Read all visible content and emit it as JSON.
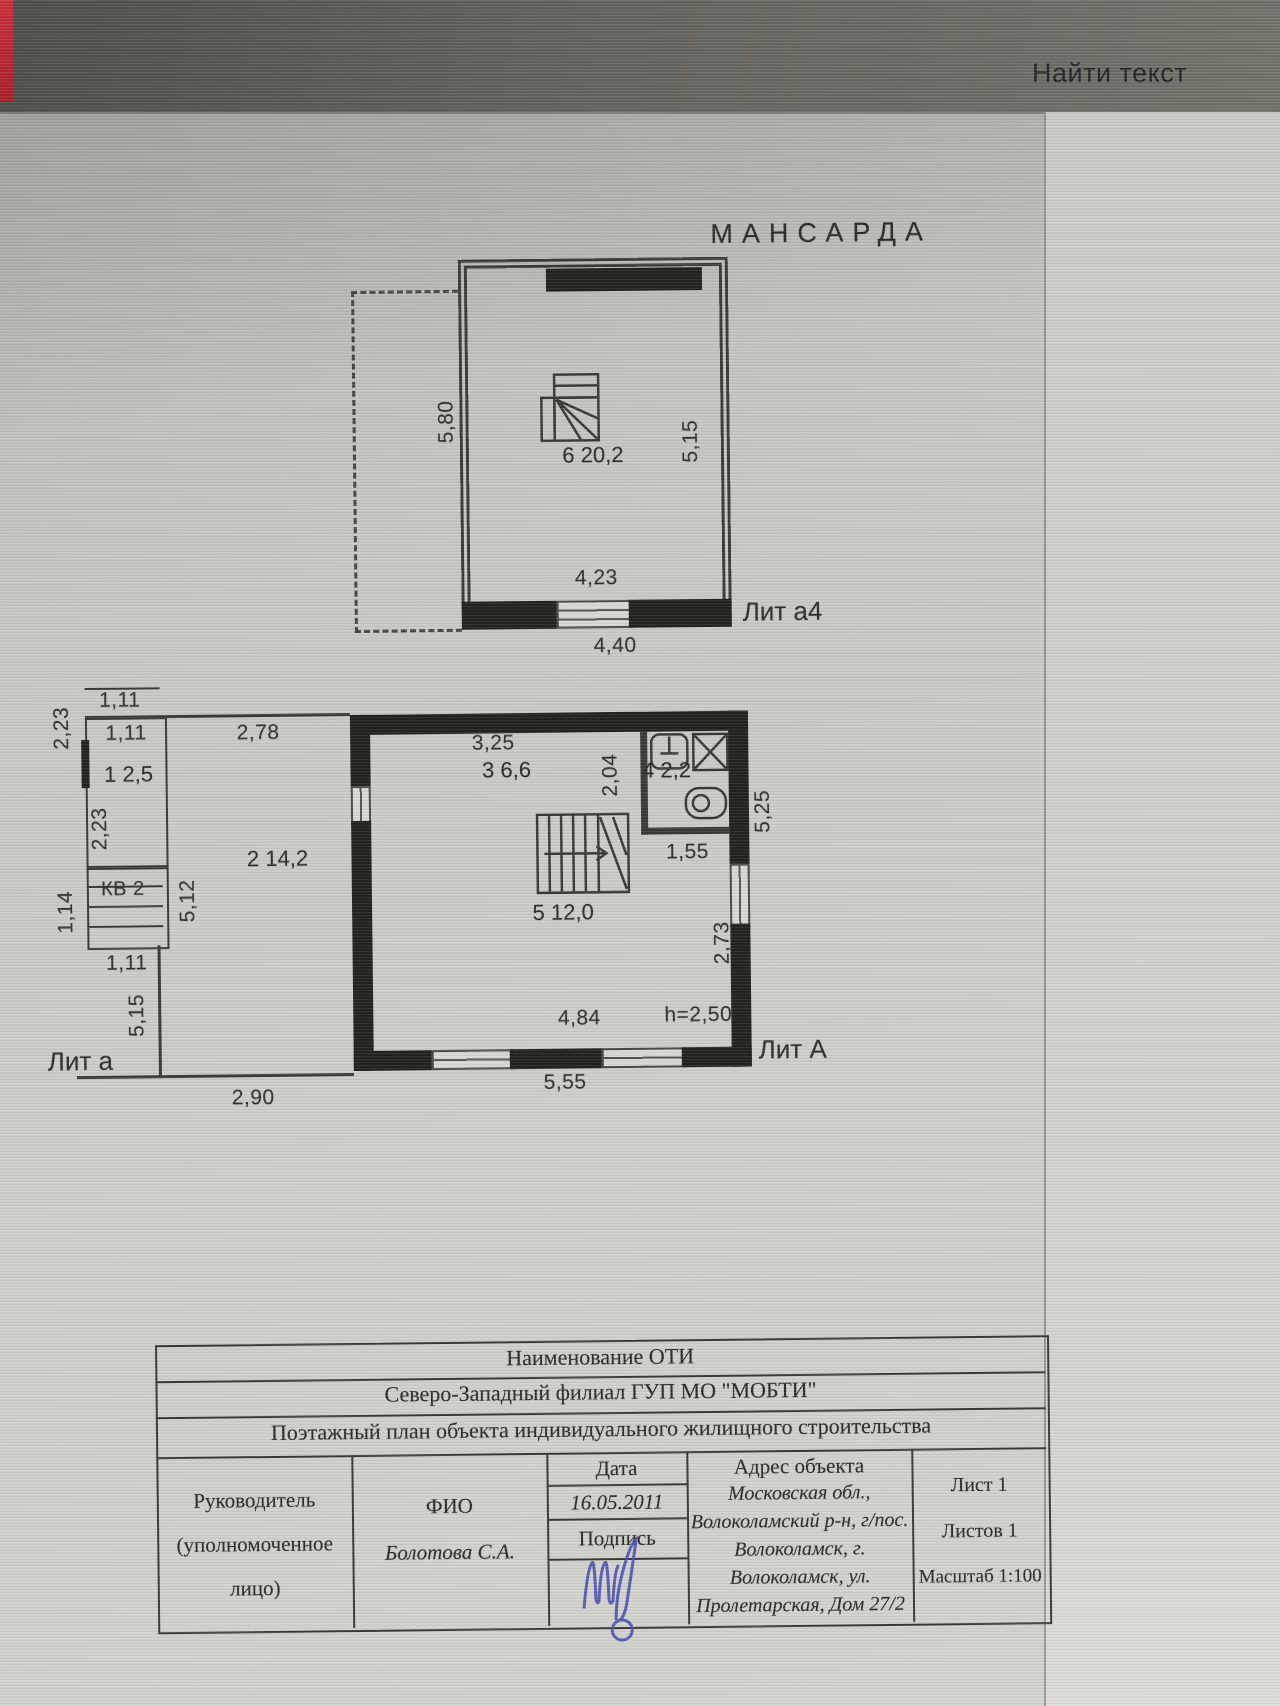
{
  "viewer": {
    "find_text": "Найти текст"
  },
  "mansarda": {
    "title": "МАНСАРДА",
    "lit": "Лит а4",
    "room": {
      "num": "6",
      "area": "20,2"
    },
    "dims": {
      "left": "5,80",
      "right": "5,15",
      "width_inner": "4,23",
      "width_outer": "4,40"
    }
  },
  "floor1": {
    "lit_annex": "Лит а",
    "lit_main": "Лит А",
    "kv": "КВ 2",
    "height_note": "h=2,50",
    "rooms": {
      "r1": {
        "num": "1",
        "area": "2,5"
      },
      "r2": {
        "num": "2",
        "area": "14,2"
      },
      "r3": {
        "num": "3",
        "area": "6,6"
      },
      "r4": {
        "num": "4",
        "area": "2,2"
      },
      "r5": {
        "num": "5",
        "area": "12,0"
      }
    },
    "dims": {
      "top111": "1,11",
      "inner111": "1,11",
      "left223": "2,23",
      "inner223": "2,23",
      "w278": "2,78",
      "w325": "3,25",
      "h204": "2,04",
      "h114": "1,14",
      "h512": "5,12",
      "bot111": "1,11",
      "h515": "5,15",
      "w290": "2,90",
      "w155": "1,55",
      "h273": "2,73",
      "h525": "5,25",
      "w484": "4,84",
      "w555": "5,55"
    }
  },
  "table": {
    "rows": [
      "Наименование ОТИ",
      "Северо-Западный филиал ГУП МО \"МОБТИ\"",
      "Поэтажный план объекта индивидуального жилищного строительства"
    ],
    "executive": {
      "line1": "Руководитель",
      "line2": "(уполномоченное",
      "line3": "лицо)"
    },
    "fio": {
      "label": "ФИО",
      "value": "Болотова С.А."
    },
    "date": {
      "label": "Дата",
      "value": "16.05.2011"
    },
    "sign_label": "Подпись",
    "address": {
      "label": "Адрес объекта",
      "lines": [
        "Московская обл.,",
        "Волоколамский р-н, г/пос.",
        "Волоколамск, г.",
        "Волоколамск, ул.",
        "Пролетарская, Дом 27/2"
      ]
    },
    "sheet": "Лист 1",
    "sheets": "Листов 1",
    "scale": "Масштаб 1:100"
  }
}
